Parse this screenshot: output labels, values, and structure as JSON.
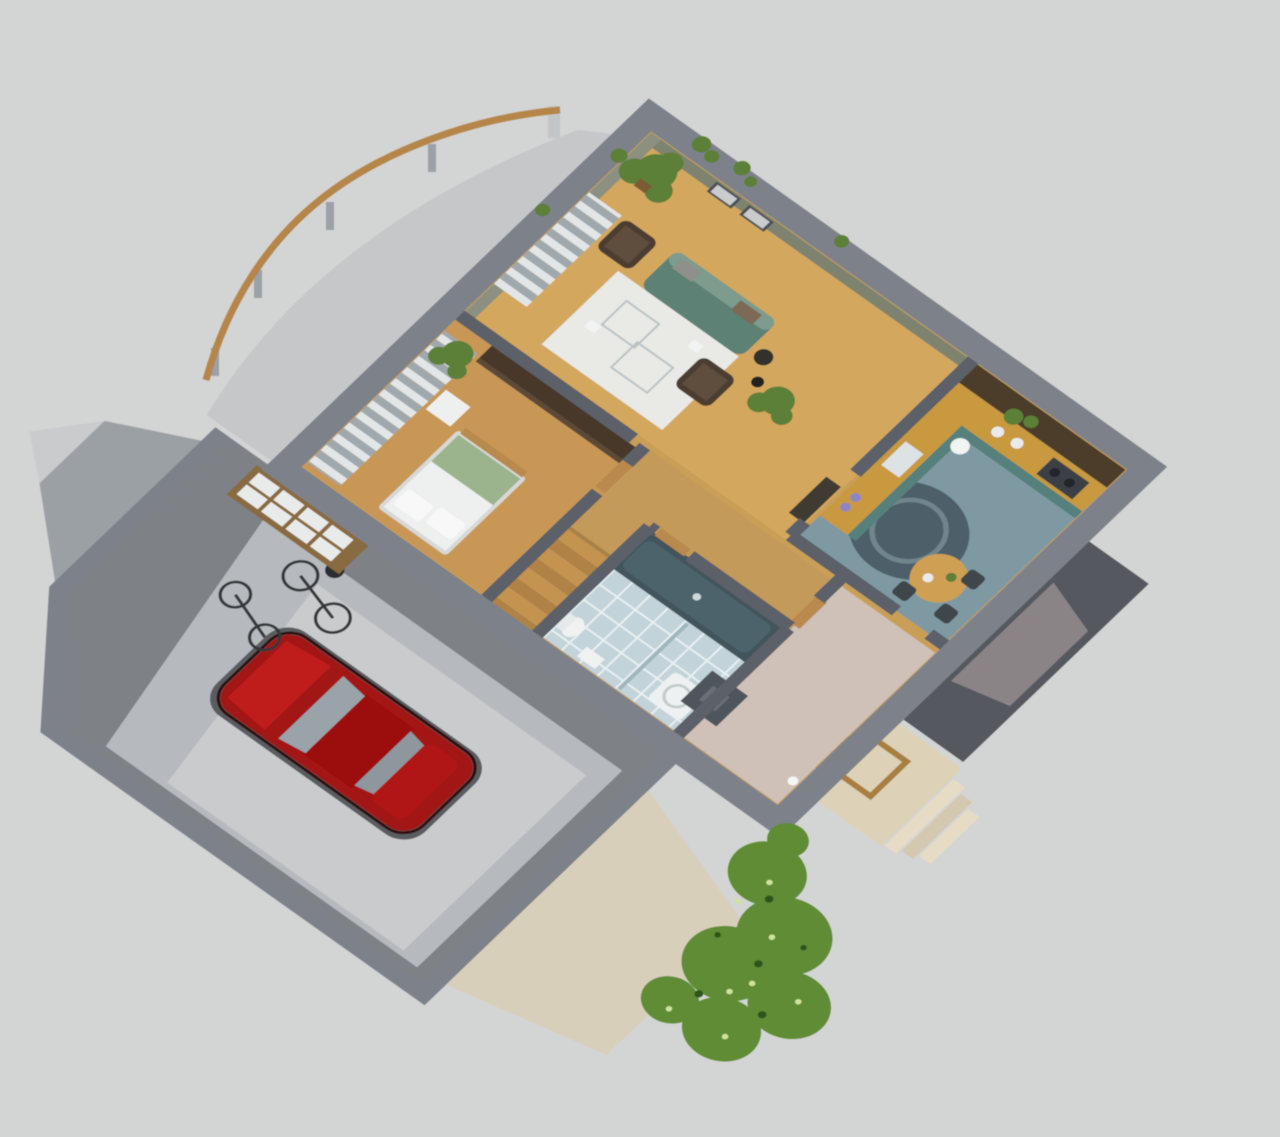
{
  "scene": {
    "description": "isometric-3d-cutaway-house-floor-plan-render",
    "rooms": [
      "living-room",
      "kitchen",
      "bedroom",
      "bathroom",
      "stair-hall",
      "corridor",
      "entry-hall",
      "garage",
      "terrace",
      "entry-porch"
    ],
    "objects": [
      "red-car",
      "bicycles",
      "garage-window",
      "sofa",
      "armchairs",
      "white-rug",
      "glass-coffee-tables",
      "floor-lamp",
      "framed-pictures",
      "potted-plants",
      "kitchen-counter",
      "cooktop",
      "dining-table",
      "kitchen-rug",
      "bed",
      "pillows",
      "green-blanket",
      "wardrobe",
      "striped-curtains",
      "bathtub",
      "shower-tray",
      "toilet",
      "sink",
      "staircase",
      "chimney-block",
      "terrace-railing",
      "garage-ramp",
      "entry-steps",
      "hedge-bushes",
      "gable-roof",
      "entry-canopy"
    ],
    "colors": {
      "bg": "#d3d4d4",
      "wallOuter": "#7d828a",
      "wallInner": "#5b6068",
      "wallEdgeDark": "#4b5056",
      "oliveWall": "#7e8370",
      "oliveWall2": "#8b9080",
      "deck": "#c5c7c9",
      "roofSlope": "#9ba0a5",
      "gableWhite": "#c9cbcd",
      "ramp": "#d8cfbb",
      "canopyDark": "#55595f",
      "canopyInner": "#8a8487",
      "porchBeige": "#ddd2b8",
      "stepLight": "#e6dcc6",
      "stepMid": "#d3c8b0",
      "doorWood": "#b9894d",
      "frameWoodDark": "#a87f41",
      "garageFloor": "#7e8287",
      "garagePad": "#b6b9bd",
      "garagePadLight": "#c9cbcd",
      "carShadow": "#5a5d61",
      "carRed": "#a31212",
      "carRedDark": "#9c0f0f",
      "carRedLight": "#bf1f1f",
      "carTrunk": "#b01717",
      "carOutline": "#331111",
      "glassGray": "#9aa3aa",
      "glassGrayDark": "#8e979e",
      "bikeDark": "#34383b",
      "bikeAccent": "#2c2f31",
      "winFrameBrown": "#8a6a40",
      "paneWhite": "#e9ebeb",
      "woodFloor": "#c99f58",
      "livingWood": "#d4a75e",
      "bedroomWood": "#c89756",
      "hallWood": "#c49a5a",
      "hallPink": "#cfc1b7",
      "kitchenBlue": "#7f99a2",
      "cabinetsDark": "#4c3c2c",
      "kitchenRug": "#4e6069",
      "kitchenRugArc": "#71858d",
      "counterWood": "#c9993f",
      "counterTeal": "#55807b",
      "cooktopDark": "#3b4046",
      "burnerDark": "#23272b",
      "sinkLight": "#dde2e4",
      "tableWood": "#cf9f52",
      "chairDark": "#3f464c",
      "windowDark": "#383d43",
      "mullionLight": "#c7cbcd",
      "rugWhite": "#e9e9e5",
      "glassLine": "#b9c2c4",
      "whiteBright": "#f2f3f3",
      "sofaTeal": "#5d8174",
      "sofaLight": "#7d9c8e",
      "pillowGray": "#8e9089",
      "pillowBrown": "#7b6a57",
      "chairBrown": "#4c3e31",
      "chairBrownCushion": "#5e4e3e",
      "blackTable": "#33302c",
      "lampBlack": "#232323",
      "plantGreen": "#5c8038",
      "potBrown": "#7b5a36",
      "shelfDark": "#403a33",
      "purpleItem": "#8f86c0",
      "wardrobeDark": "#473729",
      "wardrobeFront": "#5c4a38",
      "stripeLight": "#e3e6e7",
      "stripeDark": "#9fa8ac",
      "doorGlassDark": "#3c4044",
      "bedFrame": "#d8d8d6",
      "bedWhite": "#eeefef",
      "bedGreen": "#9cb48d",
      "pillowWhite": "#f8f8f8",
      "dresserWhite": "#eef0f0",
      "benchWood": "#b88a4e",
      "tileBlue": "#c2d3d9",
      "tileLine": "#e8f0f2",
      "tubDark": "#42545b",
      "tubInner": "#4e646c",
      "drainLight": "#cfd8da",
      "trayWhite": "#eef1f1",
      "trayRing": "#c2cbcd",
      "toiletWhite": "#f0f2f2",
      "tankWhite": "#e6e9e9",
      "partGlass": "#9fb6bc",
      "stepA": "#c39350",
      "stepB": "#b08244",
      "railDark": "#6b4f35",
      "landing": "#a8824a",
      "chimneyGray": "#4f545b",
      "chimneyNotch": "#6a6f76",
      "wallLamp": "#f4f5f5",
      "gapLight": "#caccce",
      "bushGreen": "#5f8c35",
      "bushDark": "#2f521d",
      "bushLight": "#cfe39d",
      "railWood": "#b5854a",
      "postGray": "#9ba1a7",
      "postWhite": "#c3c6c9"
    }
  }
}
